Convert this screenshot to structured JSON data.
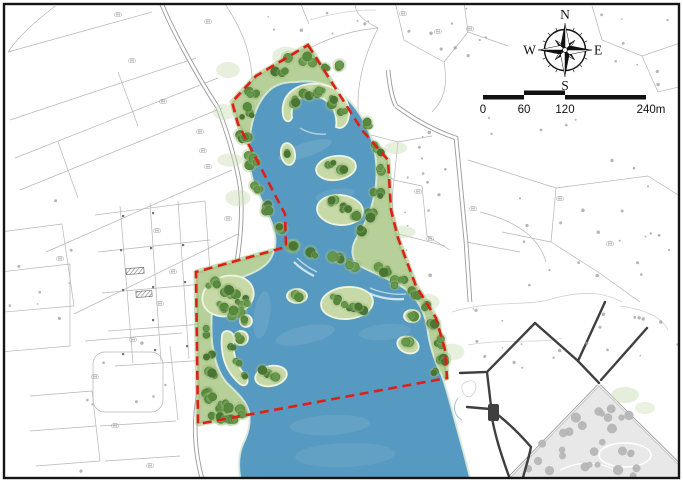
{
  "map": {
    "kind": "landscape-site-plan",
    "compass": {
      "north": "N",
      "east": "E",
      "south": "S",
      "west": "W"
    },
    "scale_bar": {
      "tick_labels": [
        "0",
        "60",
        "120"
      ],
      "end_label": "240m",
      "tick_values_m": [
        0,
        60,
        120,
        240
      ]
    },
    "parcel_label_text": "(田)",
    "parcel_labels": [
      [
        118,
        16
      ],
      [
        132,
        62
      ],
      [
        163,
        103
      ],
      [
        200,
        133
      ],
      [
        203,
        152
      ],
      [
        208,
        168
      ],
      [
        208,
        23
      ],
      [
        403,
        15
      ],
      [
        438,
        33
      ],
      [
        470,
        30
      ],
      [
        418,
        193
      ],
      [
        430,
        240
      ],
      [
        473,
        210
      ],
      [
        228,
        220
      ],
      [
        157,
        232
      ],
      [
        173,
        273
      ],
      [
        160,
        305
      ],
      [
        115,
        427
      ],
      [
        150,
        467
      ],
      [
        133,
        341
      ],
      [
        560,
        200
      ],
      [
        610,
        245
      ],
      [
        95,
        378
      ],
      [
        60,
        260
      ]
    ],
    "colors": {
      "frame": "#151515",
      "water": "#579ac1",
      "water_light": "#79aecb",
      "shore_edge": "#dcead8",
      "vegetation_base": "#b7cf98",
      "vegetation_edge": "#a3c07f",
      "island_fill": "#c6d9a6",
      "island_stroke": "#eef4e2",
      "tree_dark": "#497733",
      "tree_mid": "#578a3d",
      "tree_light": "#65984a",
      "tree_halo": "#9dbd7e",
      "boundary_red": "#de1f16",
      "parcel_line": "#b5b5b5",
      "road_gray": "#9a9a9a",
      "road_dark": "#3f3f3f",
      "park_fill": "#e8e8e8",
      "park_tree": "#b7b7b7",
      "scatter_dot": "#999e97"
    }
  }
}
